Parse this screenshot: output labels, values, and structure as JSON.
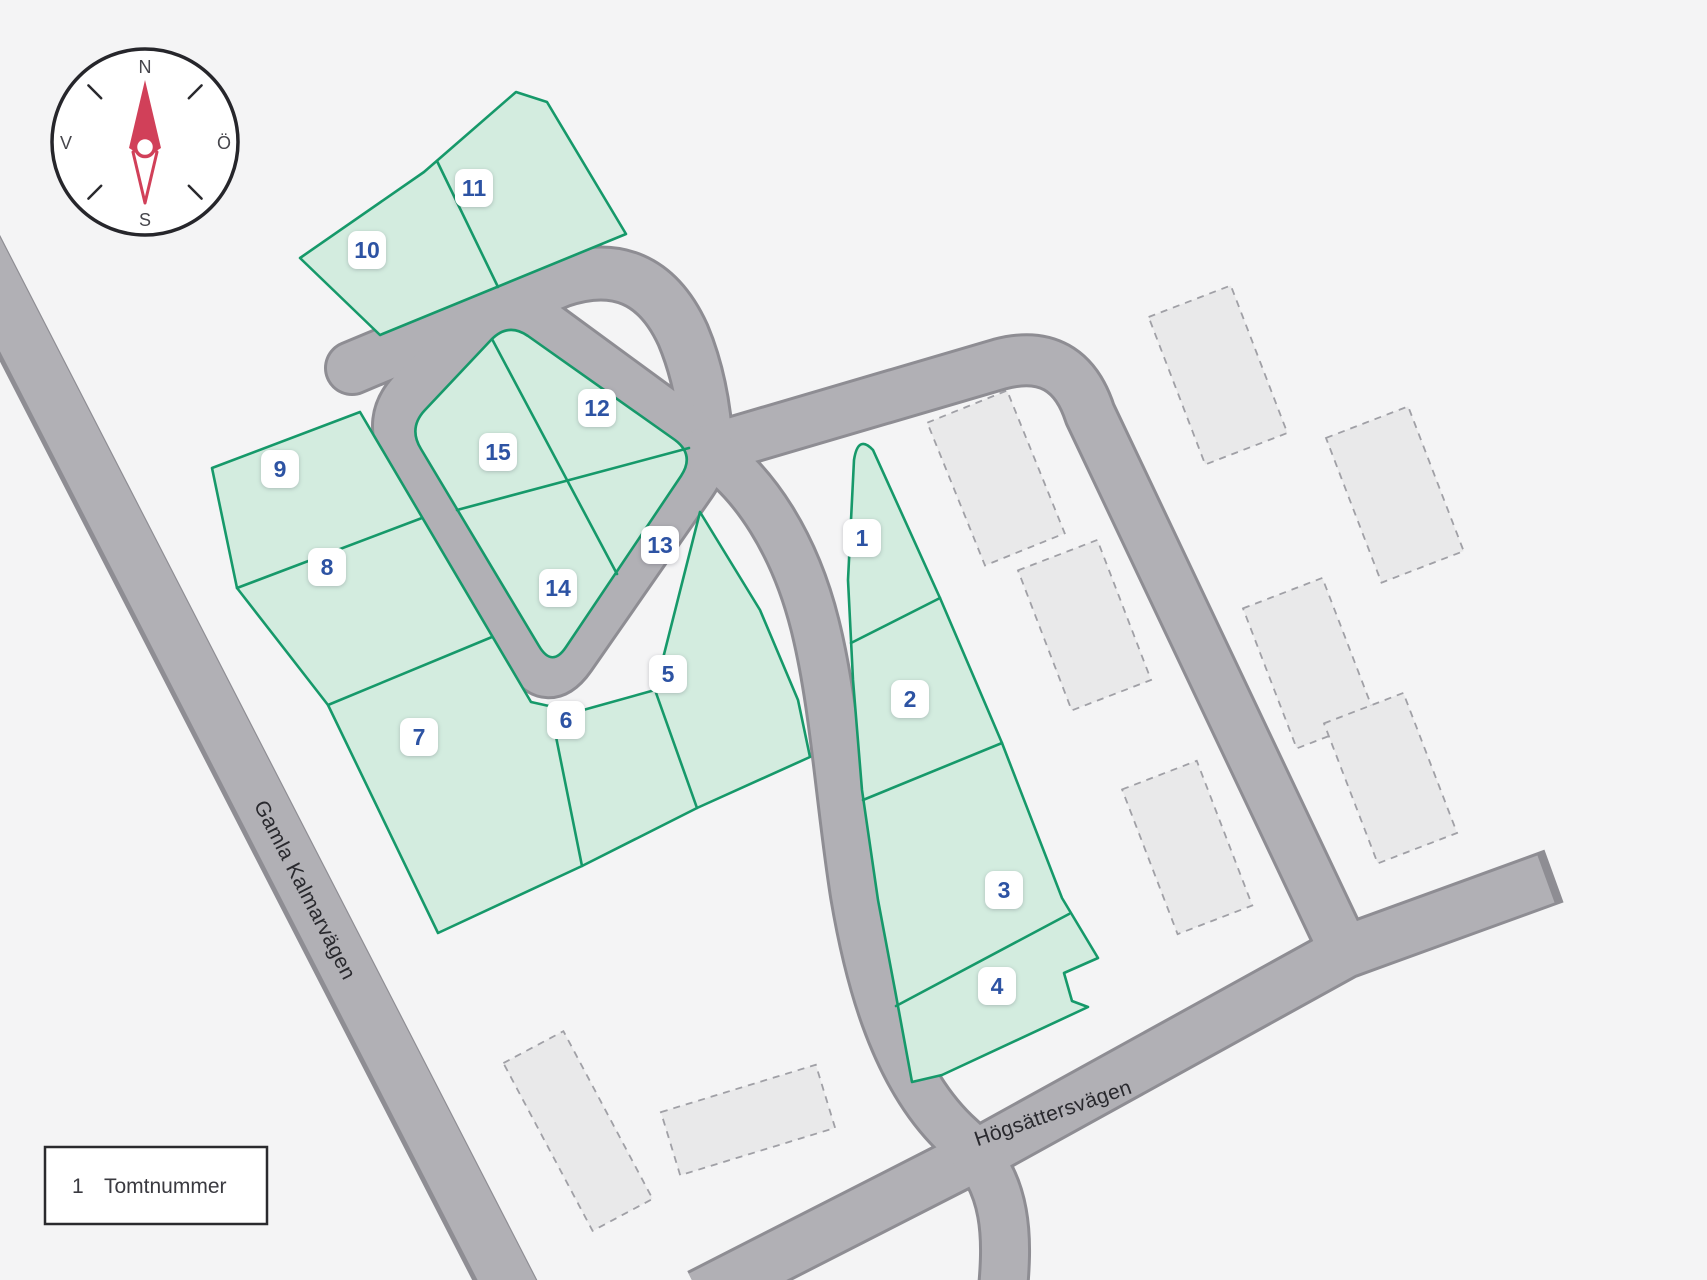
{
  "compass": {
    "north": "N",
    "east": "Ö",
    "south": "S",
    "west": "V"
  },
  "legend": {
    "key": "1",
    "label": "Tomtnummer"
  },
  "roads": [
    {
      "name": "Gamla Kalmarvägen"
    },
    {
      "name": "Högsättersvägen"
    }
  ],
  "plots": [
    {
      "number": "1"
    },
    {
      "number": "2"
    },
    {
      "number": "3"
    },
    {
      "number": "4"
    },
    {
      "number": "5"
    },
    {
      "number": "6"
    },
    {
      "number": "7"
    },
    {
      "number": "8"
    },
    {
      "number": "9"
    },
    {
      "number": "10"
    },
    {
      "number": "11"
    },
    {
      "number": "12"
    },
    {
      "number": "13"
    },
    {
      "number": "14"
    },
    {
      "number": "15"
    }
  ],
  "colors": {
    "background": "#f4f4f5",
    "plot_fill": "#d3ecdf",
    "plot_border": "#16996a",
    "road_fill": "#b1b0b5",
    "road_casing": "#8e8d93",
    "badge_number": "#2d53a3",
    "compass_needle": "#d14059",
    "building_fill": "#e9e9ea"
  }
}
